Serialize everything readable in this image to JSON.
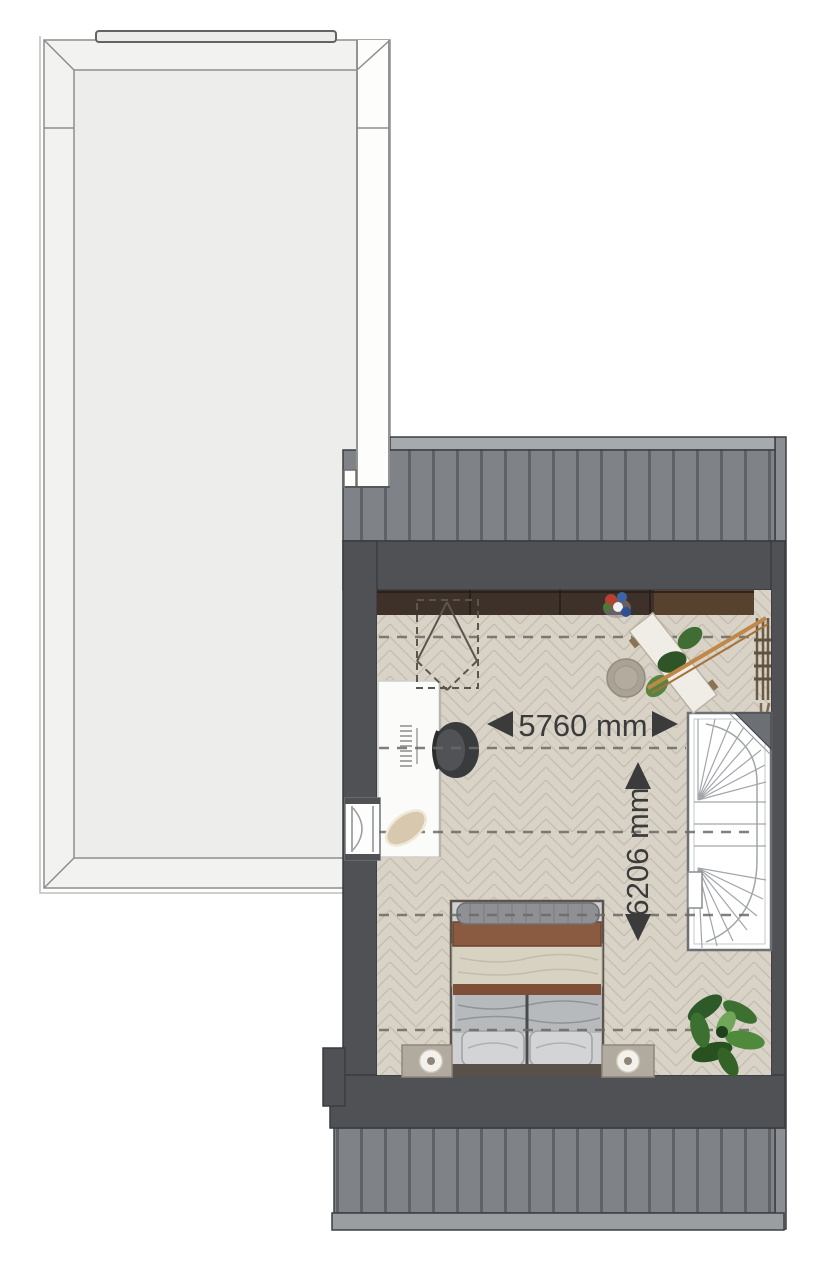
{
  "floorplan": {
    "title": "top-floor-bedroom-plan",
    "dimensions": {
      "width_label": "5760 mm",
      "depth_label": "6206 mm"
    },
    "colors": {
      "background": "#ffffff",
      "terrace_fill": "#f2f2f0",
      "terrace_inner_fill": "#ededeb",
      "terrace_line": "#8e8e8c",
      "roof": "#7f8287",
      "roof_stripe": "#5e6165",
      "roof_edge_top": "#a7aaad",
      "roof_edge_bottom": "#9b9ea1",
      "roof_edge_right": "#8b8e92",
      "wall": "#4f5155",
      "floor": "#d9d3c7",
      "floor_line": "#c5beb0",
      "wardrobe": "#3e3129",
      "label_text": "#3b3b3b"
    },
    "items": [
      "flat-roof-terrace",
      "pitched-roof-top",
      "pitched-roof-bottom",
      "bedroom-floor",
      "wardrobe",
      "skylight",
      "desk",
      "office-chair",
      "desk-cushion",
      "terrace-door",
      "round-pouf",
      "bench-with-plants",
      "wall-shelf",
      "spiral-staircase",
      "double-bed",
      "nightstand-left",
      "nightstand-right",
      "table-lamp-left",
      "table-lamp-right",
      "potted-plant",
      "flower-vase"
    ]
  }
}
